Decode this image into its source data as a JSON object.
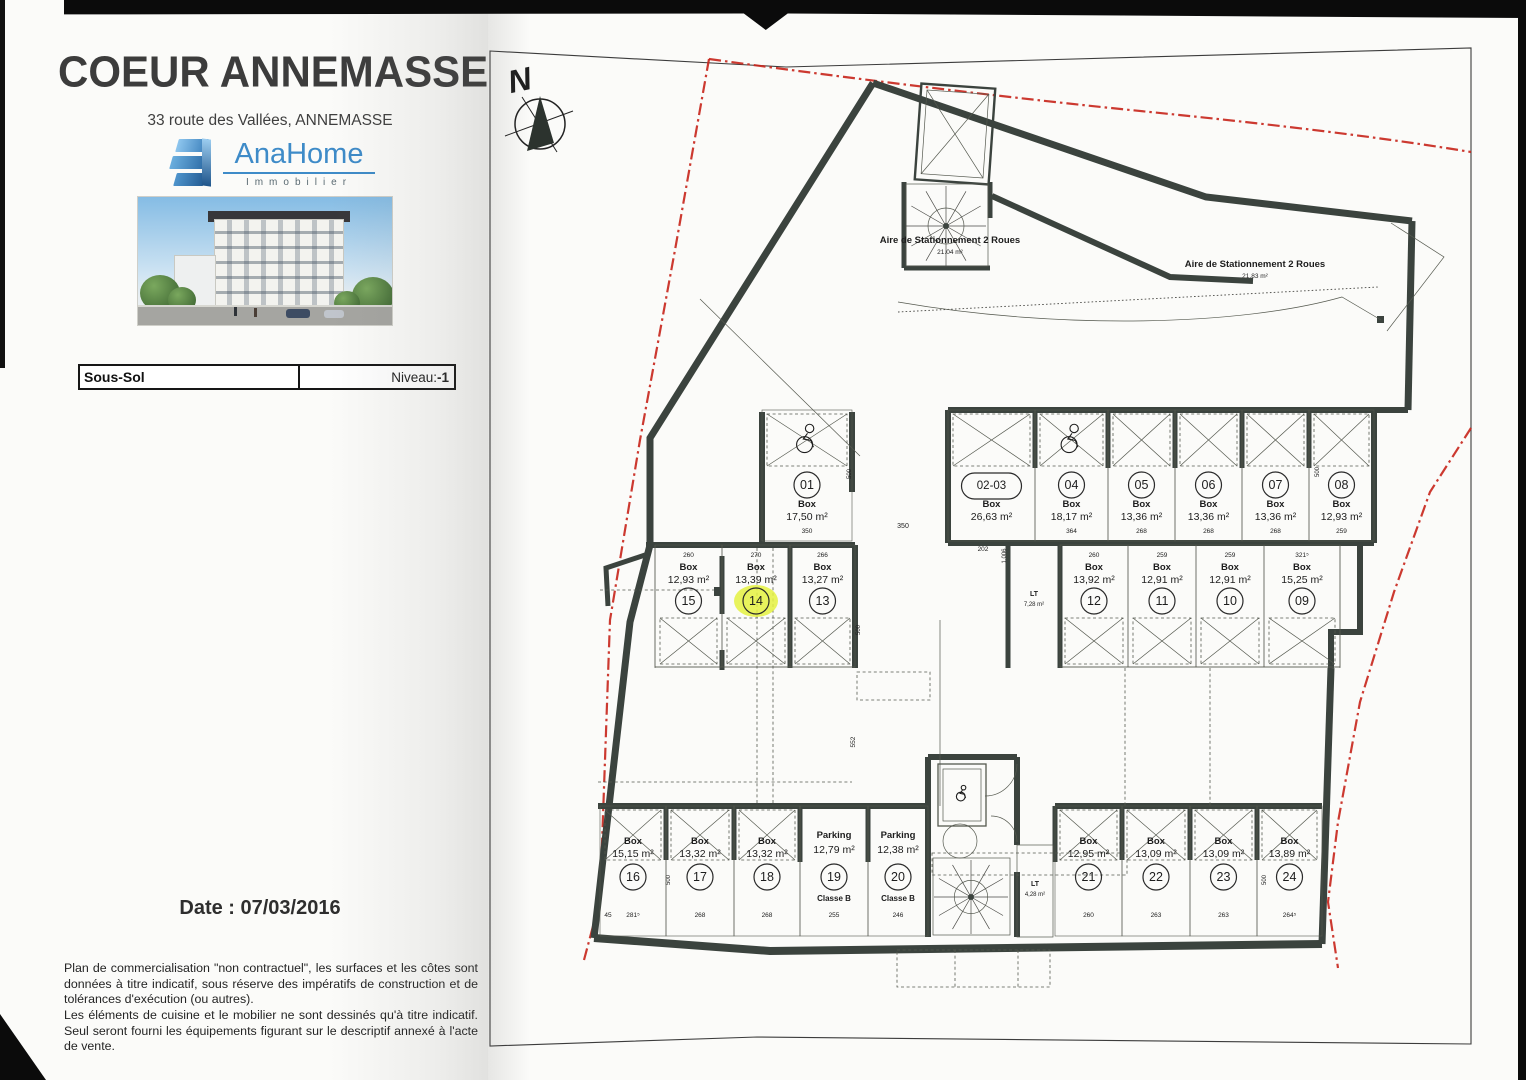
{
  "header": {
    "title": "COEUR ANNEMASSE",
    "address": "33 route des Vallées, ANNEMASSE",
    "logo_name": "AnaHome",
    "logo_sub": "Immobilier"
  },
  "level_bar": {
    "left": "Sous-Sol",
    "niveau_label": "Niveau: ",
    "niveau_value": "-1"
  },
  "date_text": "Date : 07/03/2016",
  "disclaimer": {
    "p1": "Plan de commercialisation \"non contractuel\", les surfaces et les côtes sont données à titre indicatif, sous réserve des impératifs de construction et de tolérances d'exécution (ou autres).",
    "p2": "Les éléments de cuisine et le mobilier ne sont dessinés qu'à titre indicatif. Seul seront fourni les équipements figurant sur le descriptif annexé à l'acte de vente."
  },
  "plan": {
    "north": "N",
    "level_name": "Sous-Sol",
    "highlight_color": "#e4f141",
    "wall_color": "#3b433e",
    "boundary_color": "#c8281e",
    "bike_area_1": {
      "label": "Aire de Stationnement 2 Roues",
      "area": "21.04 m²"
    },
    "bike_area_2": {
      "label": "Aire de Stationnement 2 Roues",
      "area": "21.83 m²"
    },
    "lt_1": {
      "label": "LT",
      "area": "7,28 m²"
    },
    "lt_2": {
      "label": "LT",
      "area": "4,28 m²"
    },
    "misc_dims": {
      "aisle": "350",
      "vert": "552",
      "d202": "202",
      "d1006": "1.006",
      "d500": "500"
    },
    "boxes": [
      {
        "id": "01",
        "num": "01",
        "type": "Box",
        "area": "17,50 m²",
        "dim": "350",
        "handicap": true
      },
      {
        "id": "02-03",
        "num": "02-03",
        "type": "Box",
        "area": "26,63 m²",
        "dim": ""
      },
      {
        "id": "04",
        "num": "04",
        "type": "Box",
        "area": "18,17 m²",
        "dim": "364",
        "handicap": true
      },
      {
        "id": "05",
        "num": "05",
        "type": "Box",
        "area": "13,36 m²",
        "dim": "268"
      },
      {
        "id": "06",
        "num": "06",
        "type": "Box",
        "area": "13,36 m²",
        "dim": "268"
      },
      {
        "id": "07",
        "num": "07",
        "type": "Box",
        "area": "13,36 m²",
        "dim": "268"
      },
      {
        "id": "08",
        "num": "08",
        "type": "Box",
        "area": "12,93 m²",
        "dim": "259"
      },
      {
        "id": "09",
        "num": "09",
        "type": "Box",
        "area": "15,25 m²",
        "dim": "321⁵"
      },
      {
        "id": "10",
        "num": "10",
        "type": "Box",
        "area": "12,91 m²",
        "dim": "259"
      },
      {
        "id": "11",
        "num": "11",
        "type": "Box",
        "area": "12,91 m²",
        "dim": "259"
      },
      {
        "id": "12",
        "num": "12",
        "type": "Box",
        "area": "13,92 m²",
        "dim": "260"
      },
      {
        "id": "13",
        "num": "13",
        "type": "Box",
        "area": "13,27 m²",
        "dim": "266"
      },
      {
        "id": "14",
        "num": "14",
        "type": "Box",
        "area": "13,39 m²",
        "dim": "270",
        "highlighted": true
      },
      {
        "id": "15",
        "num": "15",
        "type": "Box",
        "area": "12,93 m²",
        "dim": "260"
      },
      {
        "id": "16",
        "num": "16",
        "type": "Box",
        "area": "15,15 m²",
        "dim": "281⁵",
        "dim2": "45"
      },
      {
        "id": "17",
        "num": "17",
        "type": "Box",
        "area": "13,32 m²",
        "dim": "268"
      },
      {
        "id": "18",
        "num": "18",
        "type": "Box",
        "area": "13,32 m²",
        "dim": "268"
      },
      {
        "id": "19",
        "num": "19",
        "type": "Parking",
        "area": "12,79 m²",
        "dim": "255",
        "classe": "Classe B"
      },
      {
        "id": "20",
        "num": "20",
        "type": "Parking",
        "area": "12,38 m²",
        "dim": "246",
        "classe": "Classe B"
      },
      {
        "id": "21",
        "num": "21",
        "type": "Box",
        "area": "12,95 m²",
        "dim": "260"
      },
      {
        "id": "22",
        "num": "22",
        "type": "Box",
        "area": "13,09 m²",
        "dim": "263"
      },
      {
        "id": "23",
        "num": "23",
        "type": "Box",
        "area": "13,09 m²",
        "dim": "263"
      },
      {
        "id": "24",
        "num": "24",
        "type": "Box",
        "area": "13,89 m²",
        "dim": "264⁵"
      }
    ]
  }
}
